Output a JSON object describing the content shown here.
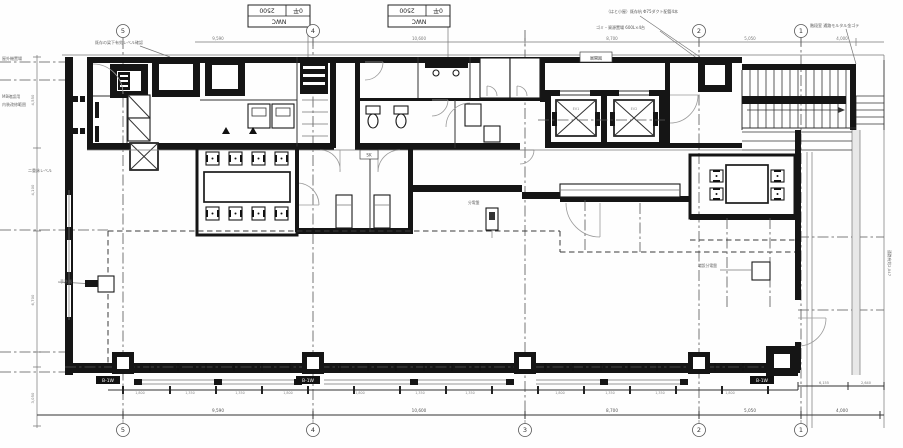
{
  "colors": {
    "ink": "#151515",
    "dim": "#777777",
    "accent_gray": "#e8e8e8"
  },
  "title_blocks": [
    {
      "x": 248,
      "y": 5,
      "cell_a": "2500",
      "cell_b": "0平",
      "cell_c": "NWC"
    },
    {
      "x": 388,
      "y": 5,
      "cell_a": "2500",
      "cell_b": "0平",
      "cell_c": "NWC"
    }
  ],
  "grid": {
    "top": [
      {
        "t": "5",
        "x": 123,
        "y": 31
      },
      {
        "t": "4",
        "x": 313,
        "y": 31
      },
      {
        "t": "2",
        "x": 699,
        "y": 31
      },
      {
        "t": "1",
        "x": 801,
        "y": 31
      }
    ],
    "bottom": [
      {
        "t": "5",
        "x": 123,
        "y": 430
      },
      {
        "t": "4",
        "x": 313,
        "y": 430
      },
      {
        "t": "3",
        "x": 525,
        "y": 430
      },
      {
        "t": "2",
        "x": 699,
        "y": 430
      },
      {
        "t": "1",
        "x": 801,
        "y": 430
      }
    ]
  },
  "badges": {
    "t": "B-1W",
    "pos": [
      [
        96,
        376
      ],
      [
        296,
        376
      ],
      [
        750,
        376
      ]
    ]
  },
  "boxed": [
    {
      "t": "展開図",
      "x": 580,
      "y": 52,
      "w": 32,
      "h": 10
    },
    {
      "t": "SK",
      "x": 360,
      "y": 150,
      "w": 18,
      "h": 9
    }
  ],
  "texts": [
    {
      "t": "既存の梁下有効レベル確認",
      "x": 95,
      "y": 44,
      "s": 4,
      "c": "#666"
    },
    {
      "t": "屋外機置場",
      "x": 2,
      "y": 60,
      "s": 4,
      "c": "#666"
    },
    {
      "t": "MB確認用",
      "x": 2,
      "y": 98,
      "s": 4,
      "c": "#666"
    },
    {
      "t": "内装改修範囲",
      "x": 2,
      "y": 106,
      "s": 4,
      "c": "#666"
    },
    {
      "t": "二重床レベル",
      "x": 28,
      "y": 172,
      "s": 4,
      "c": "#666"
    },
    {
      "t": "（はと小屋）既存杭 Φ75ダクト配管4本",
      "x": 606,
      "y": 13,
      "s": 4,
      "c": "#555"
    },
    {
      "t": "ゴミ・資源置場 600L×4台",
      "x": 596,
      "y": 29,
      "s": 4,
      "c": "#555"
    },
    {
      "t": "階段室 通路モルタル金ゴテ",
      "x": 810,
      "y": 27,
      "s": 4,
      "c": "#555"
    },
    {
      "t": "通路有効2,047",
      "x": 888,
      "y": 250,
      "s": 3.8,
      "c": "#666",
      "r": 90
    },
    {
      "t": "手洗器",
      "x": 60,
      "y": 283,
      "s": 4,
      "c": "#666"
    },
    {
      "t": "分電盤",
      "x": 468,
      "y": 204,
      "s": 3.8,
      "c": "#666"
    },
    {
      "t": "増設分電盤",
      "x": 698,
      "y": 267,
      "s": 3.8,
      "c": "#666"
    },
    {
      "t": "EV1",
      "x": 576,
      "y": 110,
      "s": 3.5,
      "c": "#888",
      "a": "middle"
    },
    {
      "t": "EV2",
      "x": 634,
      "y": 110,
      "s": 3.5,
      "c": "#888",
      "a": "middle"
    },
    {
      "t": "9,590",
      "x": 218,
      "y": 40,
      "s": 4,
      "c": "#777",
      "a": "middle"
    },
    {
      "t": "10,600",
      "x": 419,
      "y": 40,
      "s": 4,
      "c": "#777",
      "a": "middle"
    },
    {
      "t": "8,700",
      "x": 612,
      "y": 40,
      "s": 4,
      "c": "#777",
      "a": "middle"
    },
    {
      "t": "5,050",
      "x": 750,
      "y": 40,
      "s": 4,
      "c": "#777",
      "a": "middle"
    },
    {
      "t": "4,000",
      "x": 842,
      "y": 40,
      "s": 4,
      "c": "#777",
      "a": "middle"
    },
    {
      "t": "9,590",
      "x": 218,
      "y": 412,
      "s": 4.2,
      "c": "#555",
      "a": "middle"
    },
    {
      "t": "10,600",
      "x": 419,
      "y": 412,
      "s": 4.2,
      "c": "#555",
      "a": "middle"
    },
    {
      "t": "8,700",
      "x": 612,
      "y": 412,
      "s": 4.2,
      "c": "#555",
      "a": "middle"
    },
    {
      "t": "5,050",
      "x": 750,
      "y": 412,
      "s": 4.2,
      "c": "#555",
      "a": "middle"
    },
    {
      "t": "4,000",
      "x": 842,
      "y": 412,
      "s": 4.2,
      "c": "#555",
      "a": "middle"
    },
    {
      "t": "1,800",
      "x": 140,
      "y": 394,
      "s": 3.3,
      "c": "#888",
      "a": "middle"
    },
    {
      "t": "1,350",
      "x": 190,
      "y": 394,
      "s": 3.3,
      "c": "#888",
      "a": "middle"
    },
    {
      "t": "1,350",
      "x": 240,
      "y": 394,
      "s": 3.3,
      "c": "#888",
      "a": "middle"
    },
    {
      "t": "1,800",
      "x": 288,
      "y": 394,
      "s": 3.3,
      "c": "#888",
      "a": "middle"
    },
    {
      "t": "1,800",
      "x": 360,
      "y": 394,
      "s": 3.3,
      "c": "#888",
      "a": "middle"
    },
    {
      "t": "1,350",
      "x": 420,
      "y": 394,
      "s": 3.3,
      "c": "#888",
      "a": "middle"
    },
    {
      "t": "1,350",
      "x": 470,
      "y": 394,
      "s": 3.3,
      "c": "#888",
      "a": "middle"
    },
    {
      "t": "1,800",
      "x": 560,
      "y": 394,
      "s": 3.3,
      "c": "#888",
      "a": "middle"
    },
    {
      "t": "1,350",
      "x": 610,
      "y": 394,
      "s": 3.3,
      "c": "#888",
      "a": "middle"
    },
    {
      "t": "1,350",
      "x": 660,
      "y": 394,
      "s": 3.3,
      "c": "#888",
      "a": "middle"
    },
    {
      "t": "1,800",
      "x": 730,
      "y": 394,
      "s": 3.3,
      "c": "#888",
      "a": "middle"
    },
    {
      "t": "4,550",
      "x": 34,
      "y": 100,
      "s": 3.8,
      "c": "#777",
      "r": -90,
      "a": "middle"
    },
    {
      "t": "4,100",
      "x": 34,
      "y": 190,
      "s": 3.8,
      "c": "#777",
      "r": -90,
      "a": "middle"
    },
    {
      "t": "6,700",
      "x": 34,
      "y": 300,
      "s": 3.8,
      "c": "#777",
      "r": -90,
      "a": "middle"
    },
    {
      "t": "3,050",
      "x": 34,
      "y": 398,
      "s": 3.8,
      "c": "#777",
      "r": -90,
      "a": "middle"
    },
    {
      "t": "6,155",
      "x": 824,
      "y": 384,
      "s": 3.5,
      "c": "#777",
      "a": "middle"
    },
    {
      "t": "2,640",
      "x": 866,
      "y": 384,
      "s": 3.5,
      "c": "#777",
      "a": "middle"
    }
  ]
}
